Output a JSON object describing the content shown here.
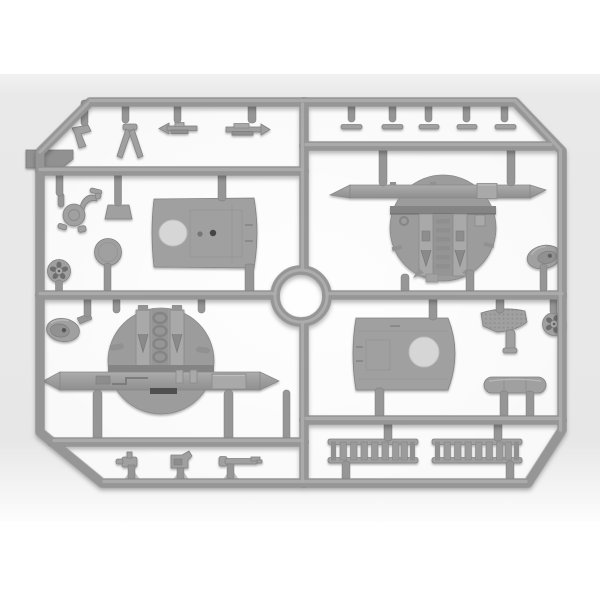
{
  "scene": {
    "type": "photograph",
    "subject": "Light gray injection-molded plastic model kit sprue (parts frame) holding aircraft model parts",
    "material": "light gray polystyrene",
    "background": "white page with soft light-gray studio backdrop band",
    "layout": "rectangular runner frame with chamfered corners, circular hub at center, cross runners dividing four quadrants of parts"
  },
  "colors": {
    "page_background": "#ffffff",
    "backdrop_band": "#e9e9e9",
    "frame_interior": "#f9f9f9",
    "plastic": "#969696",
    "plastic_light": "#aeaeae",
    "plastic_dark": "#7b7b7b",
    "part_fill": "#a0a0a0",
    "part_edge": "#828282",
    "detail_dark": "#4f4f4f",
    "hole_light": "#d6d6d6"
  },
  "parts": [
    {
      "name": "flat-blade-panel",
      "zone": "top-left corner"
    },
    {
      "name": "bent-lever",
      "zone": "top-left row"
    },
    {
      "name": "fork-strut",
      "zone": "top-left row"
    },
    {
      "name": "arrow-rod-a",
      "zone": "top-left row"
    },
    {
      "name": "arrow-rod-b",
      "zone": "top-left row"
    },
    {
      "name": "control-column",
      "zone": "left"
    },
    {
      "name": "intake-scoop",
      "zone": "left"
    },
    {
      "name": "wing-center-section-panel",
      "zone": "upper-left"
    },
    {
      "name": "round-disc",
      "zone": "left"
    },
    {
      "name": "spoked-wheel-left",
      "zone": "lower-left"
    },
    {
      "name": "flat-strip",
      "zone": "top-right row",
      "count": 5
    },
    {
      "name": "upper-cockpit-bulkhead-with-spar",
      "zone": "upper-right"
    },
    {
      "name": "teardrop-fairing-right",
      "zone": "right"
    },
    {
      "name": "teardrop-fairing-left",
      "zone": "left-middle"
    },
    {
      "name": "lower-cockpit-bulkhead-with-spar",
      "zone": "lower-left"
    },
    {
      "name": "small-bracket",
      "zone": "bottom-left row"
    },
    {
      "name": "pump-housing",
      "zone": "bottom-left row"
    },
    {
      "name": "barrel-rod",
      "zone": "bottom-left row"
    },
    {
      "name": "fuselage-side-panel",
      "zone": "lower-right"
    },
    {
      "name": "textured-paddle-board",
      "zone": "lower-right"
    },
    {
      "name": "spoked-wheel-right",
      "zone": "lower-right"
    },
    {
      "name": "cylindrical-tank",
      "zone": "lower-right"
    },
    {
      "name": "radiator-core",
      "zone": "bottom-right",
      "count": 2
    }
  ]
}
